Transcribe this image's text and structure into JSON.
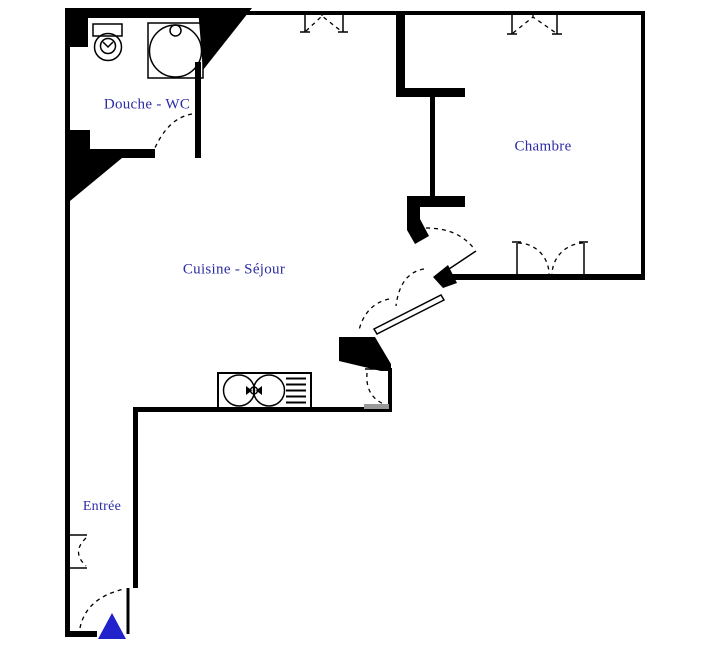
{
  "document": {
    "type": "apartment-floor-plan",
    "orientation_marker": "entrance-arrow"
  },
  "colors": {
    "background": "#ffffff",
    "wall": "#000000",
    "room_label": "#2b2ba6",
    "entrance_marker": "#2222cc",
    "sill_gray": "#9a9a9a"
  },
  "rooms": {
    "douche_wc": {
      "label": "Douche - WC"
    },
    "chambre": {
      "label": "Chambre"
    },
    "cuisine_sejour": {
      "label": "Cuisine - Séjour"
    },
    "entree": {
      "label": "Entrée"
    }
  },
  "fixtures": [
    {
      "name": "toilet",
      "room": "Douche - WC"
    },
    {
      "name": "shower-tray",
      "room": "Douche - WC"
    },
    {
      "name": "kitchen-sink-cooktop-unit",
      "room": "Cuisine - Séjour"
    },
    {
      "name": "entrance-arrow",
      "room": "Entrée"
    }
  ],
  "symbols": {
    "windows": [
      "top-wall-window-cuisine",
      "top-wall-window-chambre"
    ],
    "doors": [
      "douche-wc-door",
      "chambre-hall-door",
      "chambre-double-door",
      "cuisine-glazed-diagonal-door",
      "kitchen-service-door",
      "entree-closet-door",
      "entrance-door"
    ]
  }
}
